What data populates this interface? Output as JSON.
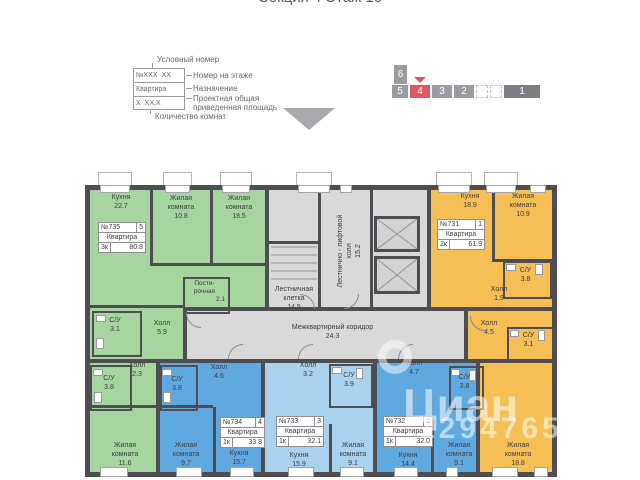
{
  "title": "Секция 4 Этаж 10",
  "legend": {
    "conditional_number": "Условный номер",
    "box": {
      "r1l": "№XXX",
      "r1r": "XX",
      "r2": "Квартира",
      "r3l": "X",
      "r3r": "XX,X"
    },
    "floor_number_note": "Номер на этаже",
    "purpose_note": "Назначение",
    "area_note": "Проектная общая\nприведенная площадь",
    "rooms_count_note": "Количество комнат"
  },
  "selector": {
    "six": "6",
    "row": [
      "5",
      "4",
      "3",
      "2"
    ],
    "one": "1",
    "active": "4",
    "colors": {
      "active": "#e0585c",
      "gray": "#9b9ca1",
      "dark": "#7e7f85"
    }
  },
  "watermark": {
    "brand": "Циан",
    "number": "129476531"
  },
  "colors": {
    "green": "#a6d5a0",
    "blue": "#60a8e0",
    "light_blue": "#a9d2ef",
    "orange": "#f5bf55",
    "gray": "#d9d9da",
    "wall": "#4d4d52"
  },
  "common_areas": {
    "stairwell": {
      "name": "Лестничная\nклетка",
      "area": "14.5"
    },
    "lift_hall": {
      "name": "Лестнично - лифтовой\nхолл",
      "area": "15.2"
    },
    "corridor": {
      "name": "Межквартирный коридор",
      "area": "24.3"
    }
  },
  "apartments": {
    "a735": {
      "num": "№735",
      "pos": "5",
      "type": "Квартира",
      "rooms": "3к",
      "total": "80.8",
      "kitchen": {
        "name": "Кухня",
        "area": "22.7"
      },
      "room1": {
        "name": "Жилая\nкомната",
        "area": "10.8"
      },
      "room2": {
        "name": "Жилая\nкомната",
        "area": "18.5"
      },
      "laundry": {
        "name": "Пости-\nрочная",
        "area": "2.1"
      },
      "wc1": {
        "name": "С/У",
        "area": "3.1"
      },
      "hall1": {
        "name": "Холл",
        "area": "5.9"
      },
      "hall2": {
        "name": "Холл",
        "area": "2.3"
      },
      "wc2": {
        "name": "С/У",
        "area": "3.8"
      },
      "room3": {
        "name": "Жилая\nкомната",
        "area": "11.6"
      }
    },
    "a734": {
      "num": "№734",
      "pos": "4",
      "type": "Квартира",
      "rooms": "1к",
      "total": "33.8",
      "hall": {
        "name": "Холл",
        "area": "4.6"
      },
      "wc": {
        "name": "С/У",
        "area": "3.8"
      },
      "room": {
        "name": "Жилая\nкомната",
        "area": "9.7"
      },
      "kitchen": {
        "name": "Кухня",
        "area": "15.7"
      }
    },
    "a733": {
      "num": "№733",
      "pos": "3",
      "type": "Квартира",
      "rooms": "1к",
      "total": "32.1",
      "hall": {
        "name": "Холл",
        "area": "3.2"
      },
      "wc": {
        "name": "С/У",
        "area": "3.9"
      },
      "kitchen": {
        "name": "Кухня",
        "area": "15.9"
      },
      "room": {
        "name": "Жилая\nкомната",
        "area": "9.1"
      }
    },
    "a732": {
      "num": "№732",
      "pos": "2",
      "type": "Квартира",
      "rooms": "1к",
      "total": "32.0",
      "hall": {
        "name": "Холл",
        "area": "4.7"
      },
      "wc": {
        "name": "С/У",
        "area": "3.8"
      },
      "kitchen": {
        "name": "Кухня",
        "area": "14.4"
      },
      "room": {
        "name": "Жилая\nкомната",
        "area": "9.1"
      }
    },
    "a731": {
      "num": "№731",
      "pos": "1",
      "type": "Квартира",
      "rooms": "2к",
      "total": "61.9",
      "kitchen": {
        "name": "Кухня",
        "area": "18.9"
      },
      "room1": {
        "name": "Жилая\nкомната",
        "area": "10.9"
      },
      "wc1": {
        "name": "С/У",
        "area": "3.8"
      },
      "hall1": {
        "name": "Холл",
        "area": "1.9"
      },
      "hall2": {
        "name": "Холл",
        "area": "4.5"
      },
      "wc2": {
        "name": "С/У",
        "area": "3.1"
      },
      "room2": {
        "name": "Жилая\nкомната",
        "area": "18.8"
      }
    }
  }
}
